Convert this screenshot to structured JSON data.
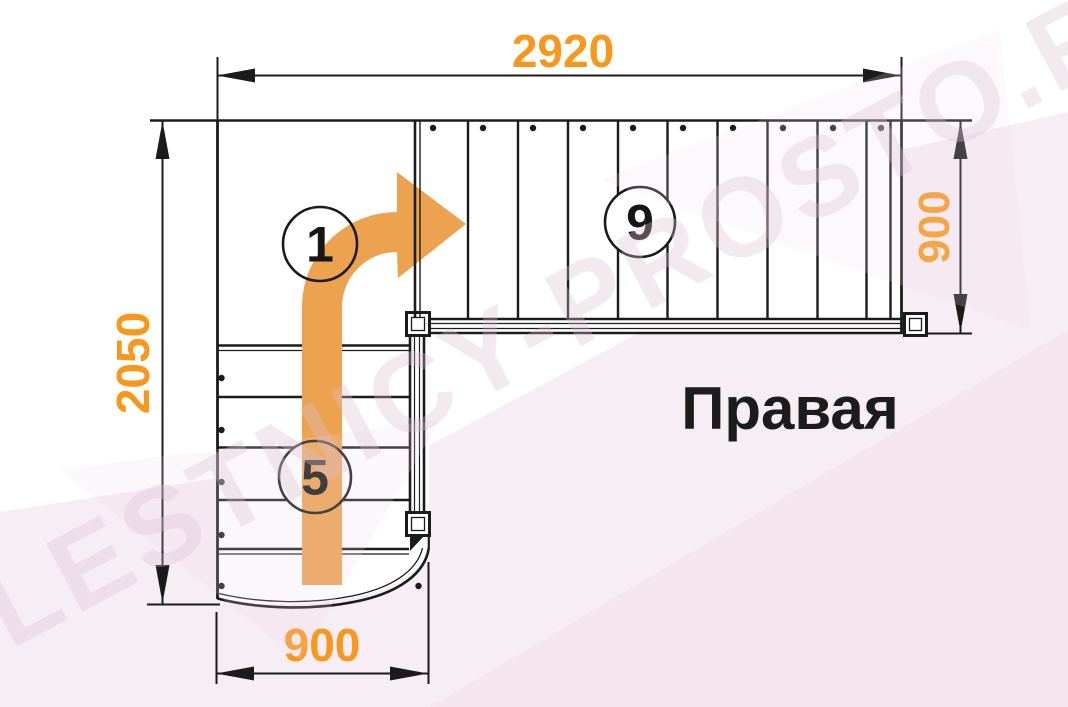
{
  "diagram": {
    "side_label": "Правая",
    "watermark_text": "LESTNICY-PROSTO.RU",
    "dimensions": {
      "top": "2920",
      "left": "2050",
      "right": "900",
      "bottom": "900"
    },
    "markers": {
      "platform": "1",
      "lower_flight_steps": "5",
      "upper_flight_steps": "9"
    },
    "colors": {
      "dimension_orange": "#F7981D",
      "arrow_orange": "#ECA24F",
      "line_black": "#1B1B1B",
      "background_pink": "#F7EDF4",
      "background_pink_deep": "#F3E2EE",
      "watermark_pink": "#DCC2D4"
    }
  }
}
